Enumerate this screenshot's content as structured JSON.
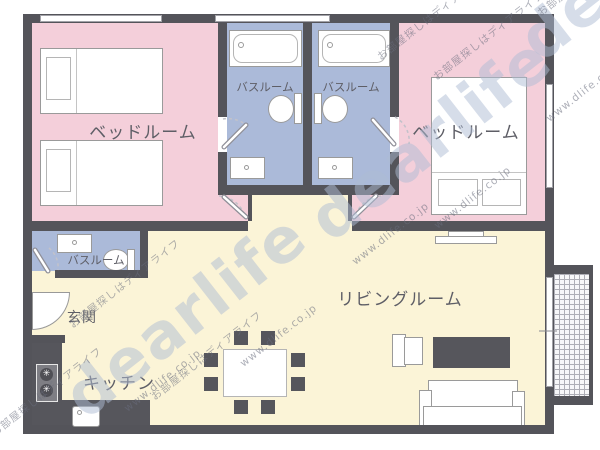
{
  "rooms": {
    "bedroom_left": {
      "label": "ベッドルーム"
    },
    "bedroom_right": {
      "label": "ベッドルーム"
    },
    "bathroom_left": {
      "label": "バスルーム"
    },
    "bathroom_right": {
      "label": "バスルーム"
    },
    "bathroom_small": {
      "label": "バスルーム"
    },
    "living": {
      "label": "リビングルーム"
    },
    "kitchen": {
      "label": "キッチン"
    },
    "entrance": {
      "label": "玄関"
    }
  },
  "watermarks": {
    "brand": "dearlife",
    "url": "www.dlife.co.jp",
    "slogan": "お部屋探しはディアライフ"
  },
  "colors": {
    "wall": "#54545a",
    "bedroom_fill": "#f4cfda",
    "bathroom_fill": "#abbad9",
    "living_fill": "#fbf4d7",
    "furniture_dark": "#56565c"
  },
  "furniture_icons": [
    "single-bed",
    "double-bed",
    "bathtub",
    "toilet",
    "sink",
    "stove",
    "kitchen-sink",
    "dining-table",
    "dining-chair",
    "sofa",
    "armchair",
    "tv",
    "tv-board",
    "front-door",
    "balcony",
    "door-swing"
  ]
}
